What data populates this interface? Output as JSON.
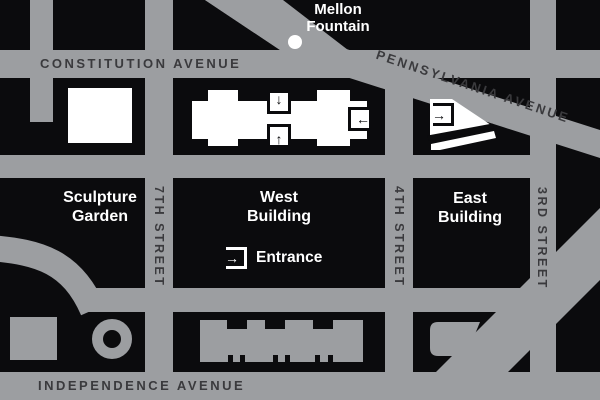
{
  "title": "National Gallery of Art area map",
  "colors": {
    "street_gray": "#9C9EA1",
    "block_black": "#0B0B0D",
    "building_white": "#FFFFFF",
    "street_label": "#3A3A3D",
    "place_label": "#FFFFFF"
  },
  "streets": {
    "constitution": "CONSTITUTION AVENUE",
    "pennsylvania": "PENNSYLVANIA AVENUE",
    "independence": "INDEPENDENCE AVENUE",
    "seventh": "7TH STREET",
    "fourth": "4TH STREET",
    "third": "3RD STREET"
  },
  "places": {
    "mellon_line1": "Mellon",
    "mellon_line2": "Fountain",
    "sculpture_line1": "Sculpture",
    "sculpture_line2": "Garden",
    "west_line1": "West",
    "west_line2": "Building",
    "east_line1": "East",
    "east_line2": "Building",
    "entrance": "Entrance"
  },
  "icons": {
    "down_arrow": "↓",
    "up_arrow": "↑",
    "left_arrow": "←",
    "right_arrow": "→",
    "fountain_dot": "white-circle"
  }
}
